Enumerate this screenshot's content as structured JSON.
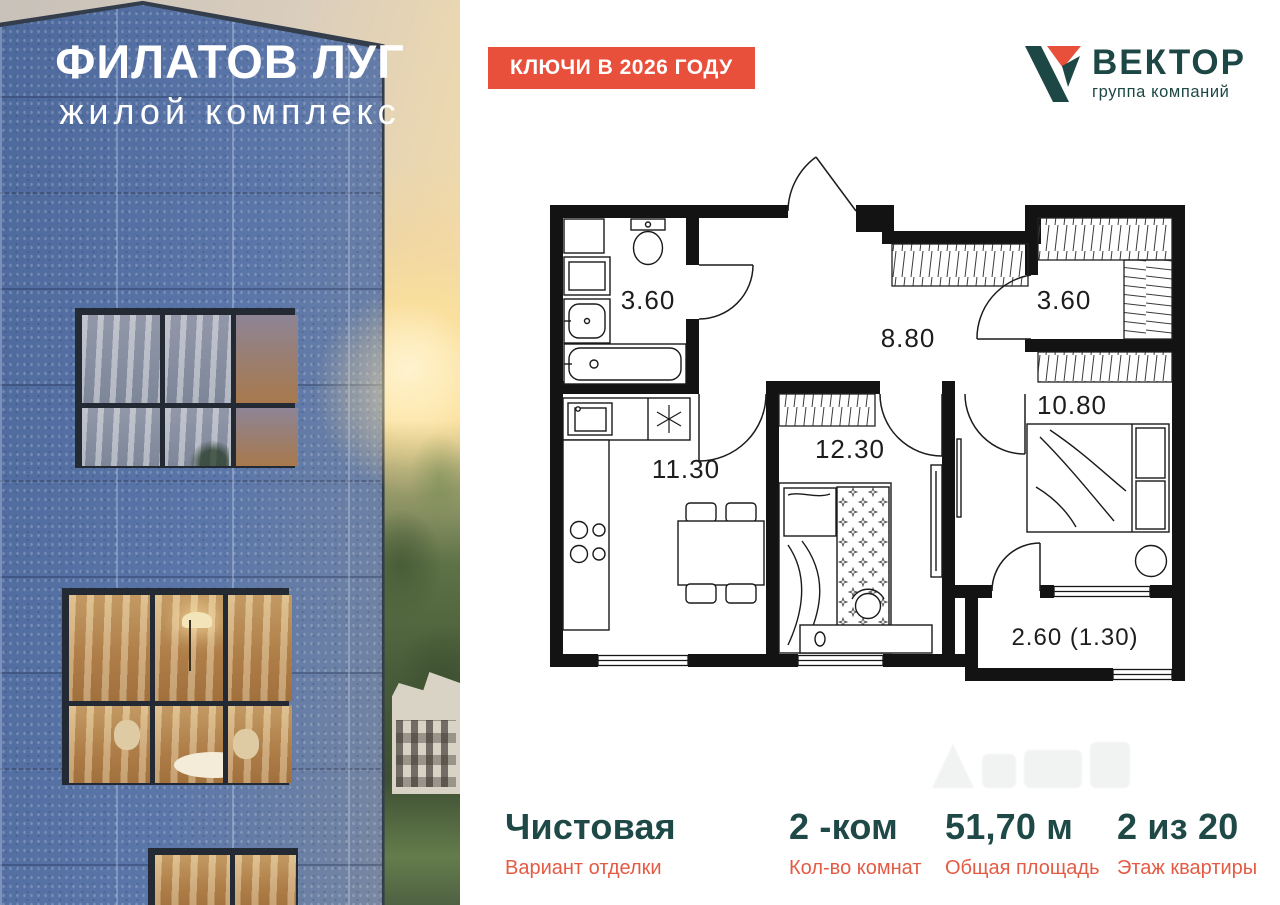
{
  "photo": {
    "project_title": "ФИЛАТОВ ЛУГ",
    "project_subtitle": "жилой комплекс"
  },
  "badge": {
    "label": "КЛЮЧИ В 2026 ГОДУ"
  },
  "logo": {
    "name": "ВЕКТОР",
    "tagline": "группа компаний"
  },
  "colors": {
    "accent_orange": "#E8503C",
    "brand_teal": "#1C4744",
    "stat_label_orange": "#E45B44",
    "plan_line": "#161616"
  },
  "floorplan": {
    "rooms": [
      {
        "name": "bathroom",
        "area": "3.60"
      },
      {
        "name": "hallway",
        "area": "8.80"
      },
      {
        "name": "wardrobe",
        "area": "3.60"
      },
      {
        "name": "kitchen-living",
        "area": "11.30"
      },
      {
        "name": "bedroom",
        "area": "12.30"
      },
      {
        "name": "bedroom-2",
        "area": "10.80"
      },
      {
        "name": "balcony",
        "area": "2.60 (1.30)"
      }
    ]
  },
  "stats": {
    "items": [
      {
        "value": "Чистовая",
        "label": "Вариант отделки"
      },
      {
        "value": "2 -ком",
        "label": "Кол-во комнат"
      },
      {
        "value": "51,70 м",
        "label": "Общая площадь"
      },
      {
        "value": "2 из 20",
        "label": "Этаж квартиры"
      }
    ]
  }
}
